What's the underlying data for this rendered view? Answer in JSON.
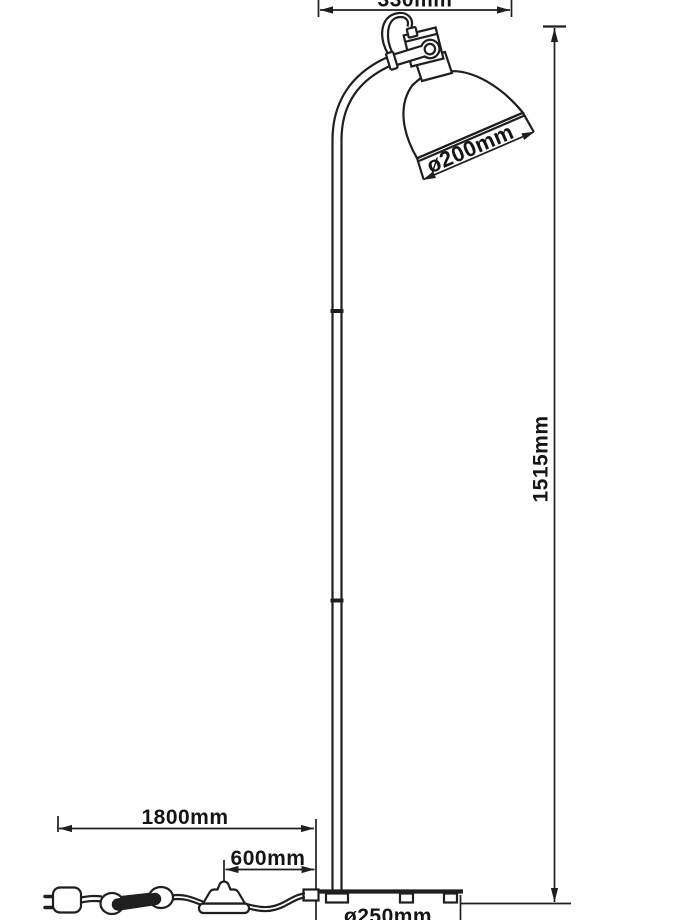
{
  "title": "Floor lamp technical line drawing with dimension annotations",
  "colors": {
    "background": "#ffffff",
    "line": "#1f1f1f",
    "text": "#151515"
  },
  "dimensions": {
    "head_width": "330mm",
    "shade_diameter": "ø200mm",
    "total_height": "1515mm",
    "cable_length": "1800mm",
    "switch_distance": "600mm",
    "base_diameter": "ø250mm"
  }
}
